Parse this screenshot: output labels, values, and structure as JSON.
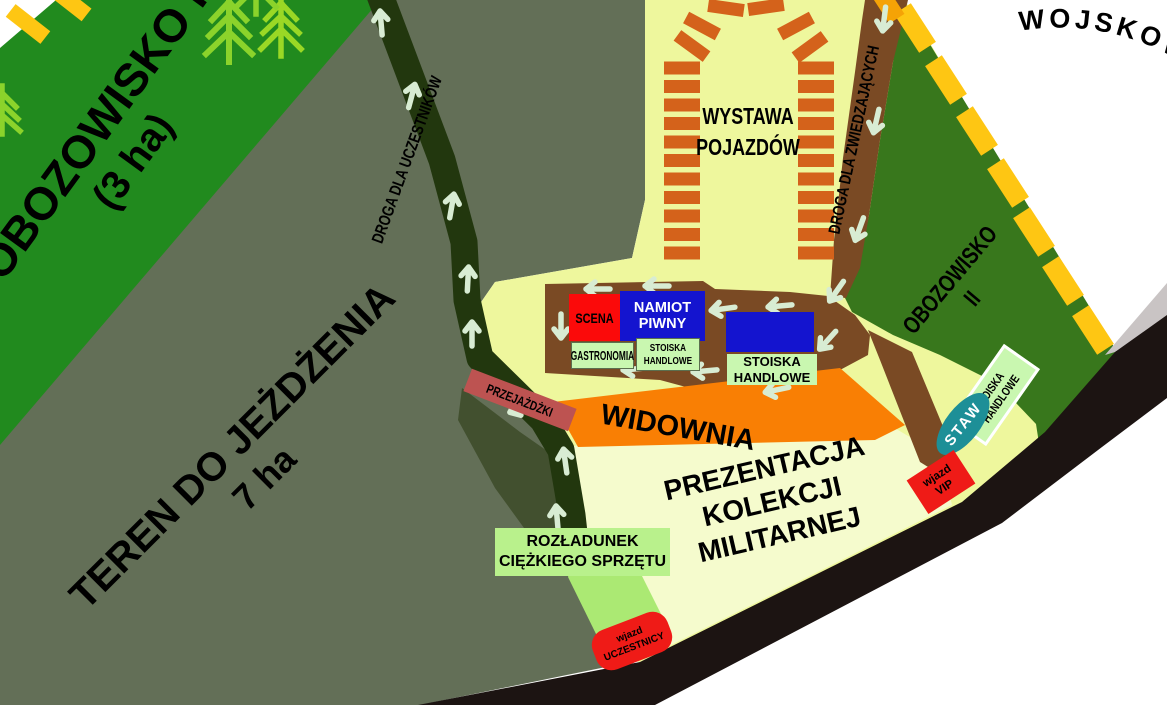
{
  "zones": {
    "obozowisko1": {
      "name": "OBOZOWISKO I",
      "area": "(3 ha)"
    },
    "teren": {
      "name": "TEREN DO JEŻDŻENIA",
      "area": "7 ha"
    },
    "droga_uczestnikow": {
      "name": "DROGA DLA UCZESTNIKÓW"
    },
    "droga_zwiedzajacych": {
      "name": "DROGA DLA ZWIEDZAJĄCYCH"
    },
    "wystawa": {
      "line1": "WYSTAWA",
      "line2": "POJAZDÓW"
    },
    "obozowisko2": {
      "line1": "OBOZOWISKO",
      "line2": "II"
    },
    "scena": {
      "name": "SCENA"
    },
    "namiot_piwny": {
      "line1": "NAMIOT",
      "line2": "PIWNY"
    },
    "gastronomia": {
      "name": "GASTRONOMIA"
    },
    "stoiska_handlowe_1": {
      "line1": "STOISKA",
      "line2": "HANDLOWE"
    },
    "stoiska_handlowe_2": {
      "line1": "STOISKA",
      "line2": "HANDLOWE"
    },
    "stoiska_handlowe_3": {
      "line1": "STOISKA",
      "line2": "HANDLOWE"
    },
    "przejazdzki": {
      "name": "PRZEJAŻDŻKI"
    },
    "widownia": {
      "name": "WIDOWNIA"
    },
    "prezentacja": {
      "line1": "PREZENTACJA",
      "line2": "KOLEKCJI",
      "line3": "MILITARNEJ"
    },
    "rozladunek": {
      "line1": "ROZŁADUNEK",
      "line2": "CIĘŻKIEGO SPRZĘTU"
    },
    "staw": {
      "name": "STAW"
    },
    "wjazd_vip": {
      "line1": "wjazd",
      "line2": "VIP"
    },
    "wjazd_uczestnicy": {
      "line1": "wjazd",
      "line2": "UCZESTNICY"
    },
    "logo_arc": {
      "text": "WOJSKOWYCH"
    }
  },
  "colors": {
    "field_yellow": "#eef79d",
    "presentation_yellow": "#f5fbcd",
    "camp1_green": "#218a1e",
    "camp2_green": "#38771c",
    "terrain_gray_green": "#636f57",
    "participants_road": "#22370e",
    "visitors_road_brown": "#7a4a24",
    "main_road_black": "#1c1412",
    "audience_orange": "#f97f04",
    "rides_rose": "#bd5351",
    "stage_red": "#fb0a0a",
    "tent_blue": "#1414cf",
    "stall_green": "#c9f7b0",
    "unload_green": "#b9f18c",
    "pond_teal": "#1d8f97",
    "entrance_red": "#ef1b17",
    "border_dash_yellow": "#fec613",
    "vehicle_dash_orange": "#d4621b",
    "arrow_light": "#d8ecd3",
    "tree_green": "#8bd32b"
  }
}
